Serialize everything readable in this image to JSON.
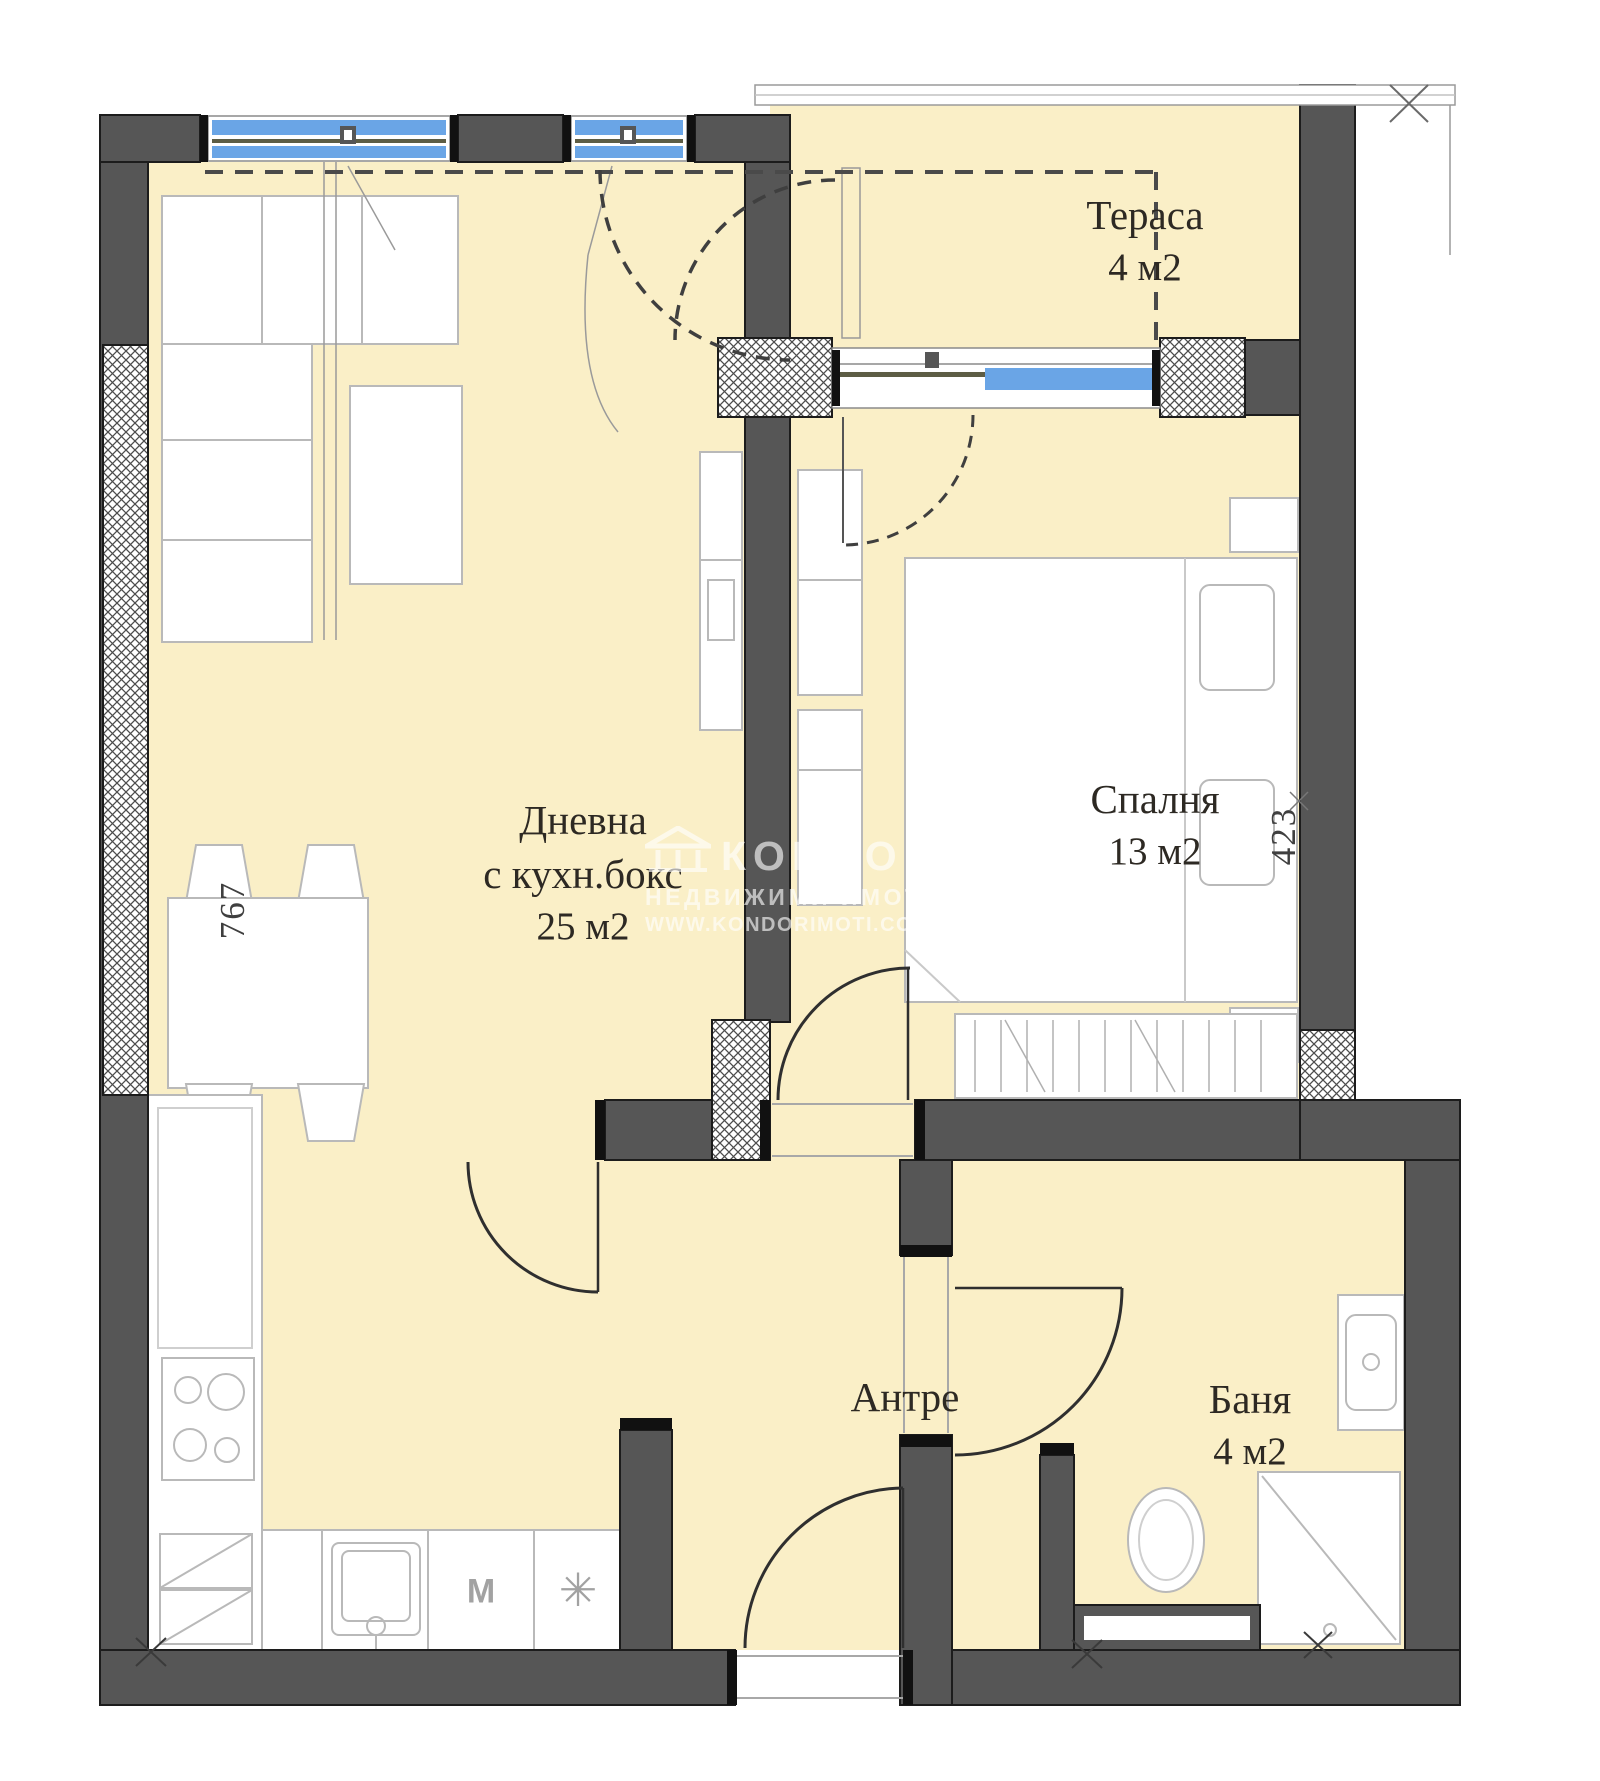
{
  "rooms": {
    "terrace": {
      "label": "Тераса",
      "area": "4 м2"
    },
    "living": {
      "label": "Дневна",
      "sublabel": "с кухн.бокс",
      "area": "25 м2"
    },
    "bedroom": {
      "label": "Спалня",
      "area": "13 м2"
    },
    "hallway": {
      "label": "Антре"
    },
    "bathroom": {
      "label": "Баня",
      "area": "4 м2"
    }
  },
  "dimensions": {
    "left_vertical": "767",
    "right_vertical": "423"
  },
  "appliances": {
    "washing_machine": "M",
    "freezer_symbol": "✳"
  },
  "watermark": {
    "brand": "КОНДОР",
    "tagline": "НЕДВИЖИМИ ИМОТИ",
    "website": "WWW.KONDORIMOTI.COM"
  },
  "colors": {
    "floor": "#faefc7",
    "wall": "#565656",
    "wall_outline": "#1c1c1c",
    "window_glass": "#6aa5e6",
    "frame_olive": "#5d5d45",
    "furniture_line": "#b9b9b9",
    "watermark": "rgba(255,255,255,0.62)"
  }
}
